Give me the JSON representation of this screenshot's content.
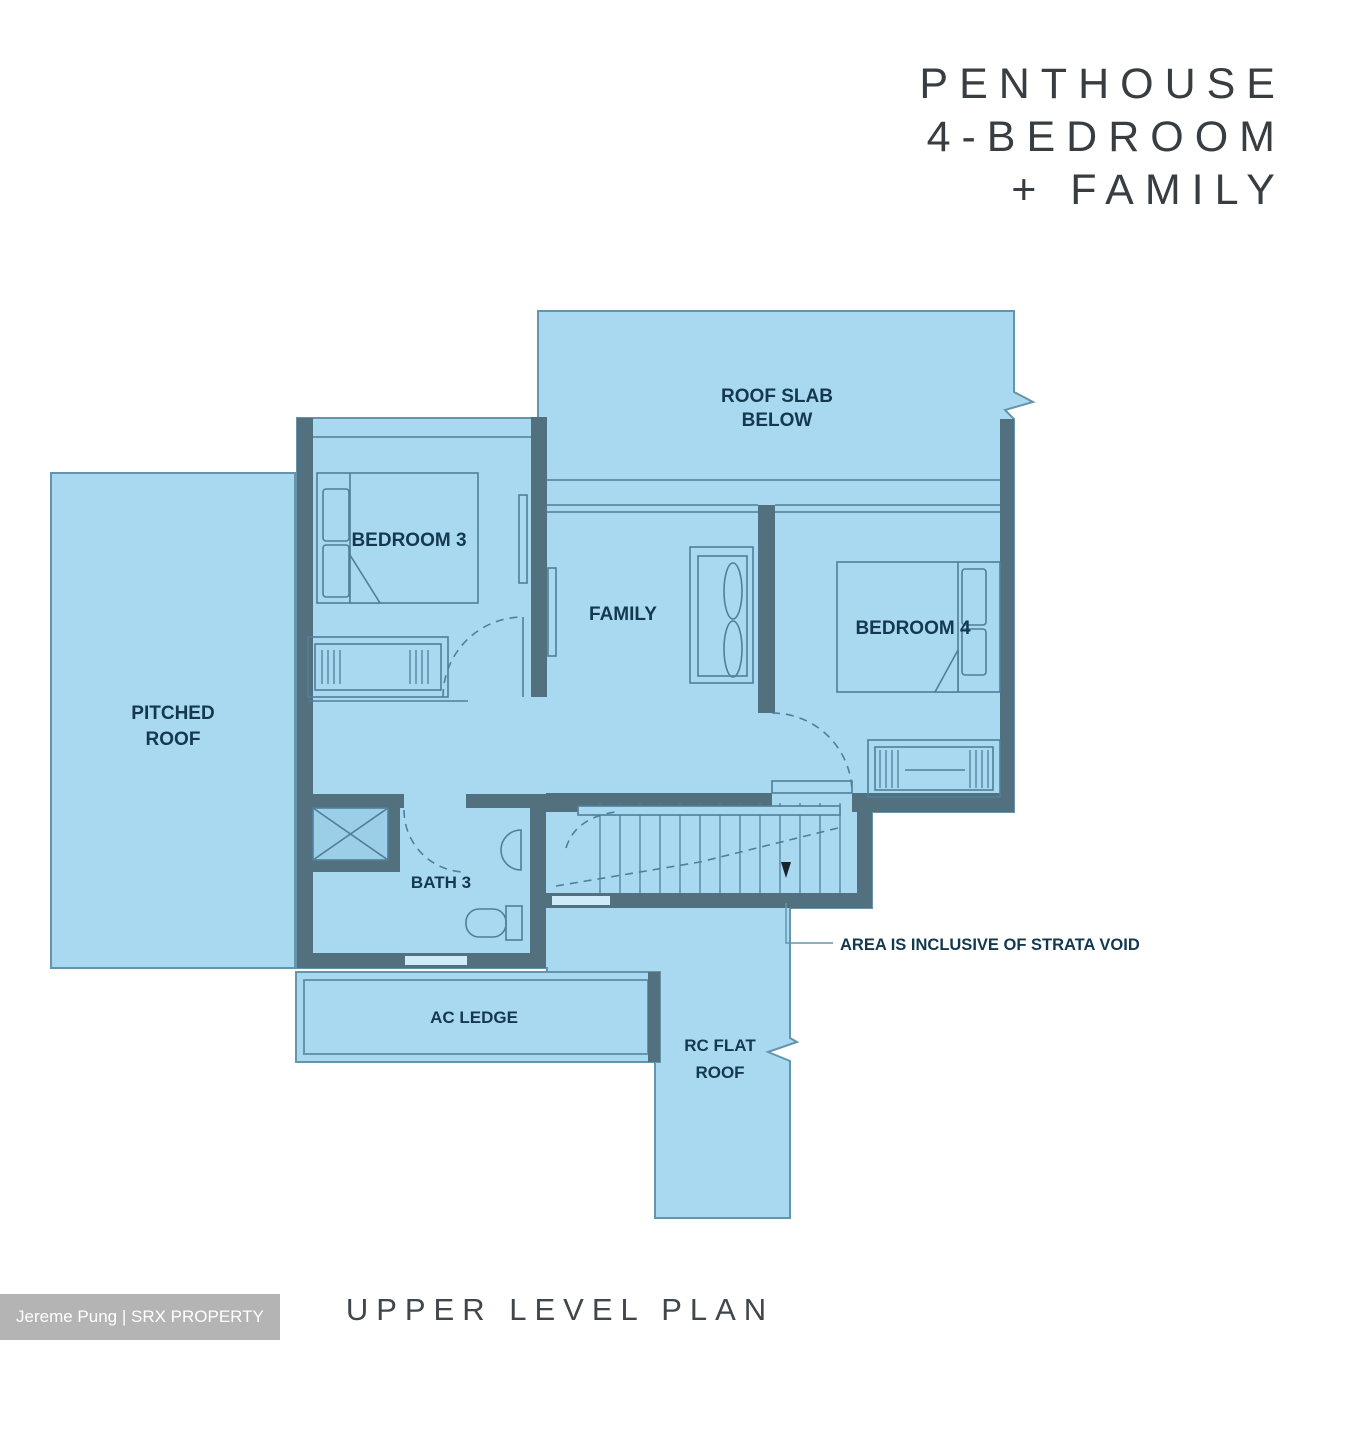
{
  "title": {
    "line1": "PENTHOUSE",
    "line2": "4-BEDROOM",
    "line3": "+ FAMILY"
  },
  "plan": {
    "rooms": {
      "roof_slab": {
        "line1": "ROOF SLAB",
        "line2": "BELOW"
      },
      "bedroom3": {
        "label": "BEDROOM 3"
      },
      "family": {
        "label": "FAMILY"
      },
      "bedroom4": {
        "label": "BEDROOM 4"
      },
      "pitched_roof": {
        "line1": "PITCHED",
        "line2": "ROOF"
      },
      "bath3": {
        "label": "BATH 3"
      },
      "ac_ledge": {
        "label": "AC LEDGE"
      },
      "rc_flat_roof": {
        "line1": "RC FLAT",
        "line2": "ROOF"
      }
    },
    "annotation": {
      "strata_void": "AREA IS INCLUSIVE OF STRATA VOID"
    }
  },
  "footer": {
    "plan_title": "UPPER LEVEL PLAN"
  },
  "watermark": {
    "text": "Jereme Pung | SRX PROPERTY"
  },
  "colors": {
    "fill": "#a9d9f1",
    "wall": "#53707e",
    "outline": "#6695ab",
    "furniture": "#4f7f99",
    "shower": "#9bcfe8",
    "window": "#cfeaf8",
    "label": "#14384e",
    "arrow": "#1a232a",
    "title_text": "#383d42",
    "footer_text": "#40464c",
    "watermark_bg": "#b4b4b4",
    "watermark_text": "#ffffff"
  }
}
